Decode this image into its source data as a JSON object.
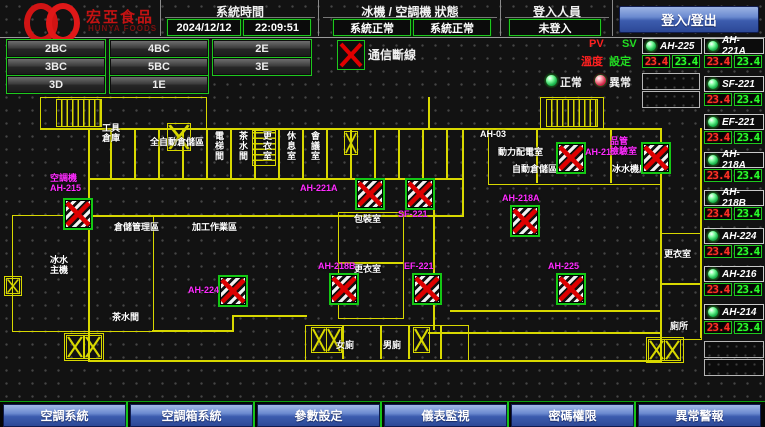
{
  "header": {
    "logo": {
      "brand": "宏亞食品",
      "brand_en": "HUNYA FOODS"
    },
    "system_time": {
      "label": "系統時間",
      "date": "2024/12/12",
      "time": "22:09:51"
    },
    "machine_status": {
      "label": "冰機 / 空調機 狀態",
      "chiller_status": "系統正常",
      "ahu_status": "系統正常"
    },
    "login": {
      "label": "登入人員",
      "status": "未登入",
      "button_label": "登入/登出"
    }
  },
  "floor_buttons": [
    "2BC",
    "4BC",
    "2E",
    "3BC",
    "5BC",
    "3E",
    "3D",
    "1E"
  ],
  "comm_alarm": {
    "label": "通信斷線"
  },
  "pv_sv": {
    "pv": "PV",
    "sv": "SV",
    "pv_sub": "溫度",
    "sv_sub": "設定"
  },
  "legend": {
    "normal": "正常",
    "abnormal": "異常"
  },
  "equipment_panel": {
    "col_a": [
      {
        "name": "AH-225",
        "pv": "23.4",
        "sv": "23.4",
        "status": "normal"
      }
    ],
    "col_a_empty": 2,
    "col_b": [
      {
        "name": "AH-221A",
        "pv": "23.4",
        "sv": "23.4",
        "status": "normal"
      },
      {
        "name": "SF-221",
        "pv": "23.4",
        "sv": "23.4",
        "status": "normal"
      },
      {
        "name": "EF-221",
        "pv": "23.4",
        "sv": "23.4",
        "status": "normal"
      },
      {
        "name": "AH-218A",
        "pv": "23.4",
        "sv": "23.4",
        "status": "normal"
      },
      {
        "name": "AH-218B",
        "pv": "23.4",
        "sv": "23.4",
        "status": "normal"
      },
      {
        "name": "AH-224",
        "pv": "23.4",
        "sv": "23.4",
        "status": "normal"
      },
      {
        "name": "AH-216",
        "pv": "23.4",
        "sv": "23.4",
        "status": "normal"
      },
      {
        "name": "AH-214",
        "pv": "23.4",
        "sv": "23.4",
        "status": "normal"
      }
    ],
    "col_b_empty": 2
  },
  "floorplan": {
    "units": [
      {
        "id": "AH-215",
        "x": 63,
        "y": 105,
        "label": "空調機\nAH-215",
        "lx": 50,
        "ly": 80
      },
      {
        "id": "AH-224",
        "x": 218,
        "y": 182,
        "label": "AH-224",
        "lx": 188,
        "ly": 192
      },
      {
        "id": "AH-221A",
        "x": 355,
        "y": 85,
        "label": "AH-221A",
        "lx": 300,
        "ly": 90
      },
      {
        "id": "AH-218B",
        "x": 329,
        "y": 180,
        "label": "AH-218B",
        "lx": 318,
        "ly": 168
      },
      {
        "id": "SF-221",
        "x": 405,
        "y": 85,
        "label": "SF-221",
        "lx": 398,
        "ly": 116
      },
      {
        "id": "EF-221",
        "x": 412,
        "y": 180,
        "label": "EF-221",
        "lx": 404,
        "ly": 168
      },
      {
        "id": "AH-218A",
        "x": 510,
        "y": 112,
        "label": "AH-218A",
        "lx": 502,
        "ly": 100
      },
      {
        "id": "AH-214",
        "x": 556,
        "y": 49,
        "label": "AH-214",
        "lx": 585,
        "ly": 54
      },
      {
        "id": "QC-AHU",
        "x": 641,
        "y": 49,
        "label": "品管\n檢驗室",
        "lx": 610,
        "ly": 43
      },
      {
        "id": "AH-225",
        "x": 556,
        "y": 180,
        "label": "AH-225",
        "lx": 548,
        "ly": 168
      }
    ],
    "room_labels": [
      {
        "t": "工具\n倉庫",
        "x": 102,
        "y": 30
      },
      {
        "t": "全自動倉儲區",
        "x": 150,
        "y": 44
      },
      {
        "t": "AH-03",
        "x": 480,
        "y": 36
      },
      {
        "t": "動力配電室",
        "x": 498,
        "y": 54
      },
      {
        "t": "自動倉儲區",
        "x": 512,
        "y": 71
      },
      {
        "t": "冰水機房",
        "x": 612,
        "y": 71
      },
      {
        "t": "倉儲管理區",
        "x": 114,
        "y": 129
      },
      {
        "t": "加工作業區",
        "x": 192,
        "y": 129
      },
      {
        "t": "冰水\n主機",
        "x": 50,
        "y": 162
      },
      {
        "t": "包裝室",
        "x": 354,
        "y": 121
      },
      {
        "t": "更衣室",
        "x": 354,
        "y": 171
      },
      {
        "t": "茶水間",
        "x": 112,
        "y": 219
      },
      {
        "t": "女廁",
        "x": 336,
        "y": 247
      },
      {
        "t": "男廁",
        "x": 383,
        "y": 247
      },
      {
        "t": "更衣室",
        "x": 664,
        "y": 156
      },
      {
        "t": "廁所",
        "x": 670,
        "y": 228
      },
      {
        "t": "電梯間",
        "x": 214,
        "y": 38,
        "v": 1
      },
      {
        "t": "茶水間",
        "x": 238,
        "y": 38,
        "v": 1
      },
      {
        "t": "更衣室",
        "x": 262,
        "y": 38,
        "v": 1
      },
      {
        "t": "休息室",
        "x": 286,
        "y": 38,
        "v": 1
      },
      {
        "t": "會議室",
        "x": 310,
        "y": 38,
        "v": 1
      }
    ],
    "walls": [
      [
        "r",
        40,
        4,
        165,
        31
      ],
      [
        "r",
        540,
        4,
        62,
        31
      ],
      [
        "l",
        40,
        35,
        622,
        2
      ],
      [
        "l",
        428,
        4,
        2,
        31
      ],
      [
        "l",
        88,
        35,
        2,
        90
      ],
      [
        "l",
        88,
        122,
        376,
        2
      ],
      [
        "l",
        462,
        35,
        2,
        89
      ],
      [
        "l",
        88,
        85,
        376,
        2
      ],
      [
        "l",
        110,
        35,
        2,
        50
      ],
      [
        "l",
        134,
        35,
        2,
        50
      ],
      [
        "l",
        158,
        35,
        2,
        50
      ],
      [
        "l",
        182,
        35,
        2,
        50
      ],
      [
        "l",
        206,
        35,
        2,
        50
      ],
      [
        "l",
        230,
        35,
        2,
        50
      ],
      [
        "l",
        254,
        35,
        2,
        50
      ],
      [
        "l",
        278,
        35,
        2,
        50
      ],
      [
        "l",
        302,
        35,
        2,
        50
      ],
      [
        "l",
        326,
        35,
        2,
        50
      ],
      [
        "l",
        350,
        35,
        2,
        50
      ],
      [
        "l",
        374,
        35,
        2,
        50
      ],
      [
        "l",
        398,
        35,
        2,
        50
      ],
      [
        "l",
        422,
        35,
        2,
        50
      ],
      [
        "l",
        446,
        35,
        2,
        50
      ],
      [
        "r",
        488,
        35,
        172,
        55
      ],
      [
        "l",
        536,
        35,
        2,
        55
      ],
      [
        "l",
        610,
        35,
        2,
        55
      ],
      [
        "r",
        12,
        122,
        140,
        115
      ],
      [
        "l",
        152,
        237,
        82,
        2
      ],
      [
        "l",
        232,
        222,
        2,
        17
      ],
      [
        "l",
        232,
        222,
        75,
        2
      ],
      [
        "r",
        338,
        119,
        64,
        50
      ],
      [
        "r",
        338,
        169,
        64,
        55
      ],
      [
        "l",
        433,
        92,
        2,
        145
      ],
      [
        "l",
        88,
        124,
        2,
        145
      ],
      [
        "l",
        88,
        267,
        574,
        2
      ],
      [
        "r",
        305,
        232,
        162,
        34
      ],
      [
        "l",
        342,
        232,
        2,
        34
      ],
      [
        "l",
        380,
        232,
        2,
        34
      ],
      [
        "l",
        408,
        232,
        2,
        34
      ],
      [
        "l",
        440,
        232,
        2,
        34
      ],
      [
        "l",
        660,
        35,
        2,
        234
      ],
      [
        "r",
        660,
        140,
        40,
        105
      ],
      [
        "l",
        660,
        190,
        40,
        2
      ],
      [
        "l",
        700,
        35,
        2,
        210
      ],
      [
        "r",
        4,
        183,
        16,
        18
      ],
      [
        "r",
        64,
        240,
        38,
        26
      ],
      [
        "r",
        646,
        244,
        36,
        24
      ],
      [
        "l",
        450,
        217,
        212,
        2
      ],
      [
        "l",
        428,
        239,
        234,
        2
      ]
    ],
    "x_marks": [
      [
        167,
        30,
        22,
        26
      ],
      [
        344,
        38,
        12,
        22
      ],
      [
        6,
        185,
        12,
        14
      ],
      [
        66,
        242,
        16,
        22
      ],
      [
        84,
        242,
        16,
        22
      ],
      [
        311,
        234,
        14,
        24
      ],
      [
        326,
        234,
        14,
        24
      ],
      [
        413,
        234,
        15,
        24
      ],
      [
        648,
        246,
        15,
        20
      ],
      [
        664,
        246,
        15,
        20
      ]
    ],
    "stairs": [
      [
        56,
        6,
        44,
        26,
        "h"
      ],
      [
        546,
        6,
        50,
        26,
        "h"
      ],
      [
        252,
        37,
        22,
        34,
        "v"
      ]
    ]
  },
  "bottom_nav": [
    "空調系統",
    "空調箱系統",
    "參數設定",
    "儀表監視",
    "密碼權限",
    "異常警報"
  ],
  "colors": {
    "accent_green": "#1ec81e",
    "alarm_red": "#e00000",
    "label_magenta": "#ff2bff",
    "plan_yellow": "#d8d800",
    "button_blue": "#3c5cae",
    "pv_red": "#ff3226",
    "sv_green": "#2bff2b"
  }
}
